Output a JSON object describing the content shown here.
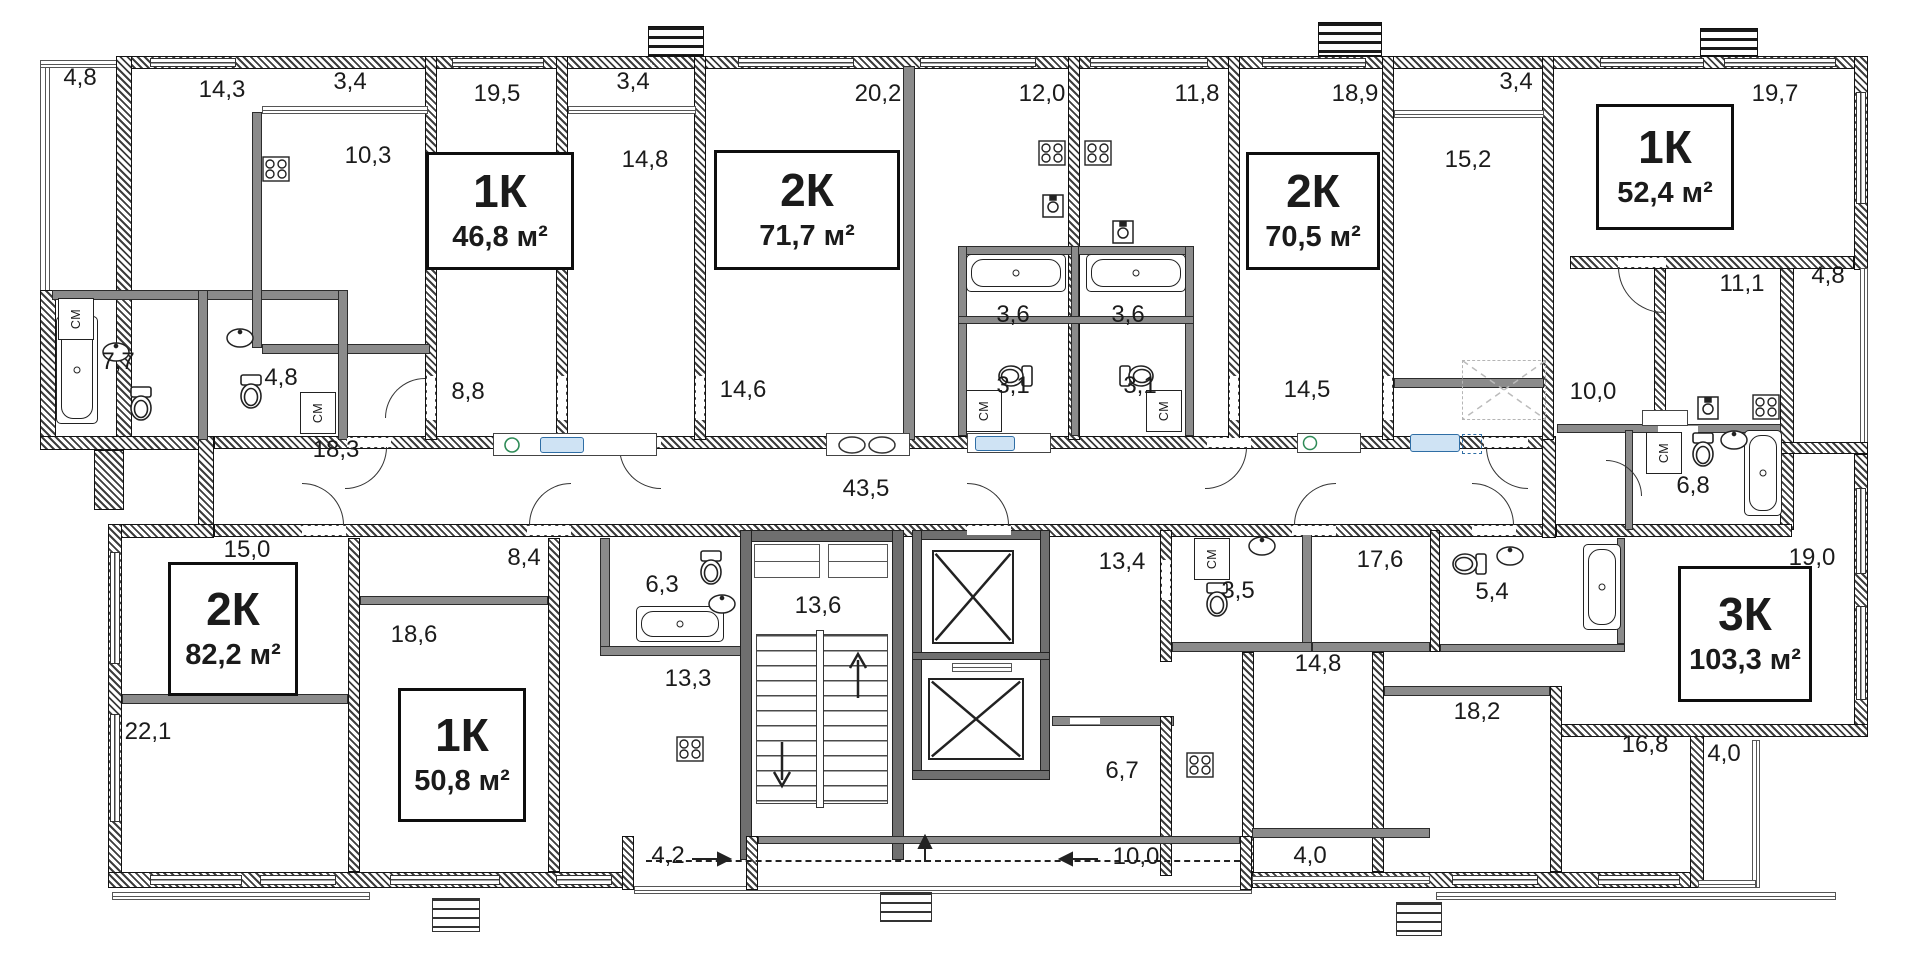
{
  "floorplan": {
    "washer_label": "СМ",
    "apartments": [
      {
        "name": "apartment-1k-top-left",
        "type": "1К",
        "area": "46,8 м²"
      },
      {
        "name": "apartment-2k-top-center",
        "type": "2К",
        "area": "71,7 м²"
      },
      {
        "name": "apartment-2k-top-right",
        "type": "2К",
        "area": "70,5 м²"
      },
      {
        "name": "apartment-1k-far-right",
        "type": "1К",
        "area": "52,4 м²"
      },
      {
        "name": "apartment-2k-bottom-left",
        "type": "2К",
        "area": "82,2 м²"
      },
      {
        "name": "apartment-1k-bottom-left",
        "type": "1К",
        "area": "50,8 м²"
      },
      {
        "name": "apartment-3k-bottom-right",
        "type": "3К",
        "area": "103,3 м²"
      }
    ],
    "rooms": [
      {
        "name": "balcony-top-left",
        "area": "4,8"
      },
      {
        "name": "bedroom-top-left",
        "area": "14,3"
      },
      {
        "name": "loggia-a",
        "area": "3,4"
      },
      {
        "name": "living-19-5",
        "area": "19,5"
      },
      {
        "name": "loggia-b",
        "area": "3,4"
      },
      {
        "name": "living-20-2",
        "area": "20,2"
      },
      {
        "name": "kitchen-12-0",
        "area": "12,0"
      },
      {
        "name": "kitchen-11-8",
        "area": "11,8"
      },
      {
        "name": "living-18-9",
        "area": "18,9"
      },
      {
        "name": "loggia-c",
        "area": "3,4"
      },
      {
        "name": "living-19-7",
        "area": "19,7"
      },
      {
        "name": "kitchen-10-3",
        "area": "10,3"
      },
      {
        "name": "room-14-8-top",
        "area": "14,8"
      },
      {
        "name": "room-15-2",
        "area": "15,2"
      },
      {
        "name": "kitchen-11-1",
        "area": "11,1"
      },
      {
        "name": "balcony-right-4-8",
        "area": "4,8"
      },
      {
        "name": "bathroom-7-7",
        "area": "7,7"
      },
      {
        "name": "bathroom-4-8",
        "area": "4,8"
      },
      {
        "name": "hall-8-8",
        "area": "8,8"
      },
      {
        "name": "room-18-3",
        "area": "18,3"
      },
      {
        "name": "room-14-6",
        "area": "14,6"
      },
      {
        "name": "bathroom-3-6-left",
        "area": "3,6"
      },
      {
        "name": "bathroom-3-6-right",
        "area": "3,6"
      },
      {
        "name": "wc-3-1-left",
        "area": "3,1"
      },
      {
        "name": "wc-3-1-right",
        "area": "3,1"
      },
      {
        "name": "room-14-5",
        "area": "14,5"
      },
      {
        "name": "hall-10-0-right",
        "area": "10,0"
      },
      {
        "name": "bathroom-6-8",
        "area": "6,8"
      },
      {
        "name": "corridor-43-5",
        "area": "43,5"
      },
      {
        "name": "room-15-0",
        "area": "15,0"
      },
      {
        "name": "room-22-1",
        "area": "22,1"
      },
      {
        "name": "room-18-6",
        "area": "18,6"
      },
      {
        "name": "hall-8-4",
        "area": "8,4"
      },
      {
        "name": "bathroom-6-3",
        "area": "6,3"
      },
      {
        "name": "stairwell-13-6",
        "area": "13,6"
      },
      {
        "name": "room-13-3",
        "area": "13,3"
      },
      {
        "name": "room-13-4",
        "area": "13,4"
      },
      {
        "name": "bathroom-3-5",
        "area": "3,5"
      },
      {
        "name": "hall-17-6",
        "area": "17,6"
      },
      {
        "name": "bathroom-5-4",
        "area": "5,4"
      },
      {
        "name": "living-19-0",
        "area": "19,0"
      },
      {
        "name": "kitchen-14-8-bottom",
        "area": "14,8"
      },
      {
        "name": "room-18-2",
        "area": "18,2"
      },
      {
        "name": "room-16-8",
        "area": "16,8"
      },
      {
        "name": "balcony-4-0-right",
        "area": "4,0"
      },
      {
        "name": "loggia-4-0-center",
        "area": "4,0"
      },
      {
        "name": "hall-4-2",
        "area": "4,2"
      },
      {
        "name": "corridor-10-0",
        "area": "10,0"
      },
      {
        "name": "kitchen-6-7",
        "area": "6,7"
      }
    ]
  }
}
